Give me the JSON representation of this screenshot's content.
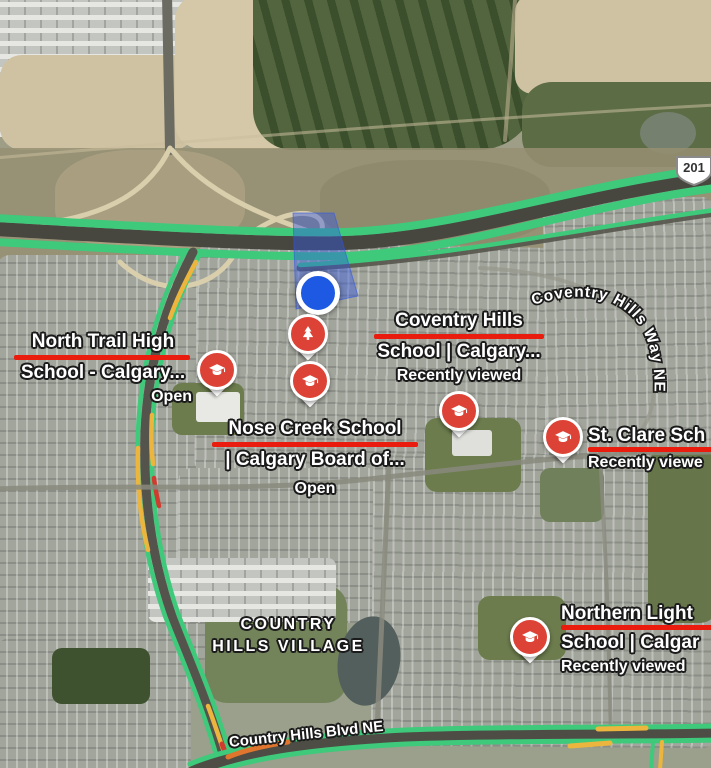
{
  "shield": {
    "label": "201"
  },
  "area_label": {
    "line1": "COUNTRY",
    "line2": "HILLS VILLAGE"
  },
  "road_labels": {
    "country_hills_blvd": "Country Hills Blvd NE",
    "coventry_hills_way": "Coventry Hills Way NE"
  },
  "places": {
    "north_trail": {
      "line1": "North Trail High",
      "line2": "School - Calgary...",
      "status": "Open",
      "marker": "school-pin",
      "icon": "graduation-cap-icon"
    },
    "coventry": {
      "line1": "Coventry Hills",
      "line2": "School | Calgary...",
      "status": "Recently viewed",
      "marker": "school-pin",
      "icon": "graduation-cap-icon"
    },
    "nose_creek": {
      "line1": "Nose Creek School",
      "line2": "| Calgary Board of...",
      "status": "Open",
      "marker": "school-pin",
      "icon": "graduation-cap-icon"
    },
    "st_clare": {
      "line1": "St. Clare Sch",
      "status": "Recently viewe",
      "marker": "school-pin",
      "icon": "graduation-cap-icon"
    },
    "northern_lights": {
      "line1": "Northern Light",
      "line2": "School | Calgar",
      "status": "Recently viewed",
      "marker": "school-pin",
      "icon": "graduation-cap-icon"
    }
  },
  "other_markers": {
    "park": {
      "marker": "park-pin",
      "icon": "pine-tree-icon"
    },
    "location": {
      "marker": "blue-location-dot"
    }
  },
  "colors": {
    "traffic_green": "#3ec97b",
    "traffic_yellow": "#ecb53e",
    "traffic_red": "#d03b2f",
    "marker_red": "#dd4236",
    "underline_red": "#ea1c0d",
    "location_blue": "#1d59e3",
    "selection_fill": "rgba(47,85,232,0.42)"
  }
}
